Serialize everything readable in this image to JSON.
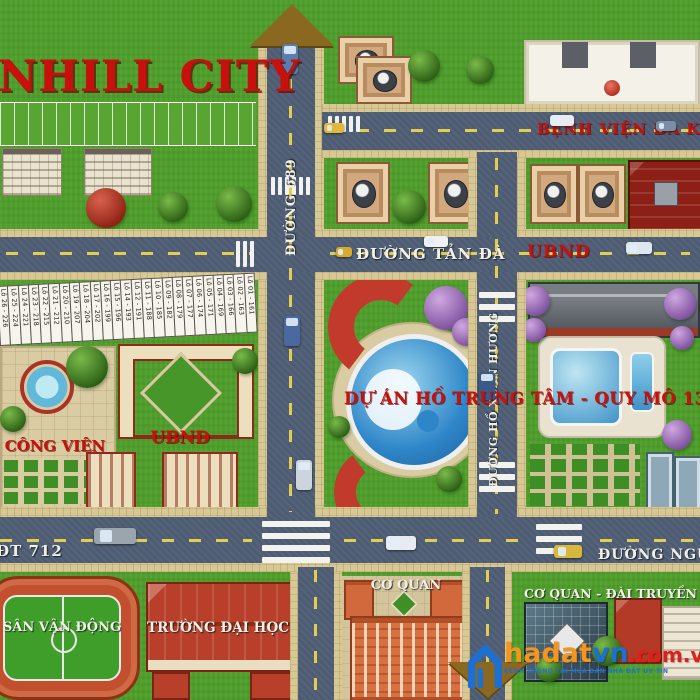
{
  "title": "NHILL CITY",
  "roads": {
    "d689": "ĐƯỜNG 689",
    "tanda": "ĐƯỜNG TẢN ĐÀ",
    "hoxuanhuong": "ĐƯỜNG HỒ XUÂN HƯƠNG",
    "benhvien": "BỆNH VIỆN ĐA K",
    "ubnd_sign": "UBND",
    "dt712": "ĐT 712",
    "nguyen": "ĐƯỜNG NGUY"
  },
  "areas": {
    "congvien": "CÔNG VIÊN",
    "ubnd": "UBND",
    "duan": "DỰ ÁN HỒ TRUNG TÂM - QUY MÔ 13.7HA",
    "svd": "SÂN VẬN ĐỘNG",
    "daihoc": "TRƯỜNG ĐẠI HỌC",
    "coquan": "CƠ QUAN",
    "daitruyenhinh": "CƠ QUAN - ĐÀI TRUYỀN HÌ"
  },
  "lots": [
    "Lô 26 - 226",
    "Lô 25 - 224",
    "Lô 24 - 221",
    "Lô 23 - 218",
    "Lô 22 - 215",
    "Lô 21 - 212",
    "Lô 20 - 210",
    "Lô 19 - 207",
    "Lô 18 - 204",
    "Lô 17 - 202",
    "Lô 16 - 199",
    "Lô 15 - 196",
    "Lô 14 - 193",
    "Lô 12 - 191",
    "Lô 11 - 188",
    "Lô 10 - 185",
    "Lô 09 - 182",
    "Lô 08 - 179",
    "Lô 07 - 177",
    "Lô 06 - 174",
    "Lô 05 - 171",
    "Lô 04 - 169",
    "Lô 03 - 166",
    "Lô 02 - 163",
    "Lô 01 - 161"
  ],
  "watermark": {
    "brand_hadat": "hadat",
    "brand_vn": "vn",
    "brand_domain": ".com.vn",
    "tagline": "KÊNH THÔNG TIN MUA BÁN NHÀ ĐẤT UY TÍN"
  },
  "colors": {
    "accent_red": "#c8100c",
    "road": "#4d5c72",
    "grass": "#4f9e2b",
    "sidewalk": "#d8c893",
    "label_white": "#f3efe2",
    "logo_blue": "#1f6fd0",
    "logo_orange": "#f6951d",
    "logo_red": "#e31e18"
  }
}
